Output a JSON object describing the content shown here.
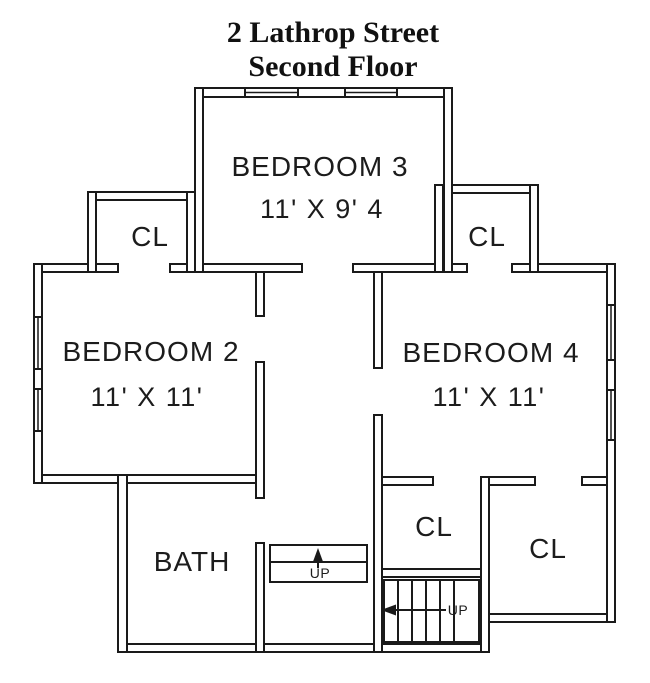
{
  "title": {
    "line1": "2 Lathrop Street",
    "line2": "Second Floor"
  },
  "rooms": {
    "bedroom3": {
      "name": "BEDROOM 3",
      "dims": "11' X 9' 4"
    },
    "bedroom2": {
      "name": "BEDROOM 2",
      "dims": "11' X 11'"
    },
    "bedroom4": {
      "name": "BEDROOM 4",
      "dims": "11' X 11'"
    },
    "bath": {
      "name": "BATH"
    },
    "closet_top_left": {
      "name": "CL"
    },
    "closet_top_right": {
      "name": "CL"
    },
    "closet_bottom_center": {
      "name": "CL"
    },
    "closet_bottom_right": {
      "name": "CL"
    }
  },
  "stairs": {
    "attic": {
      "label": "UP"
    },
    "main": {
      "label": "UP"
    }
  },
  "colors": {
    "wall_line": "#1a1a1a",
    "background": "#ffffff",
    "text": "#1c1c1c"
  }
}
